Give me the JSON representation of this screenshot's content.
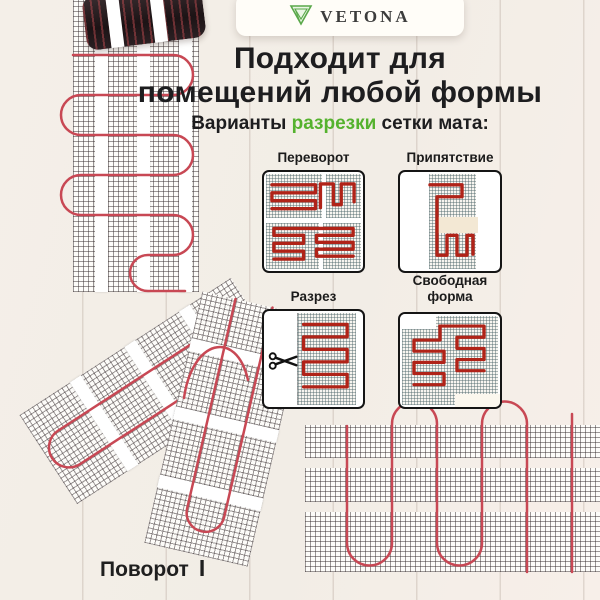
{
  "logo": {
    "brand": "VETONA",
    "icon": "gem-triangle-icon"
  },
  "heading": {
    "line1": "Подходит для",
    "line2": "помещений любой формы"
  },
  "subheading": {
    "prefix": "Варианты ",
    "highlight": "разрезки",
    "suffix": " сетки мата:"
  },
  "variants": [
    {
      "label": "Переворот"
    },
    {
      "label": "Припятствие"
    },
    {
      "label": "Разрез"
    },
    {
      "label": "Свободная форма"
    }
  ],
  "bottom_label": {
    "text": "Поворот",
    "marker": "I"
  },
  "icons": {
    "logo": "gem-triangle-icon",
    "cut": "scissors-icon"
  },
  "colors": {
    "accent_green": "#55b22e",
    "cable_red": "#b02318",
    "photo_cable_red": "#c84854",
    "text_dark": "#1d1d1f",
    "background": "#f2ede6",
    "obstacle_beige": "#f3e8d4",
    "mat_black": "#241a1c"
  }
}
